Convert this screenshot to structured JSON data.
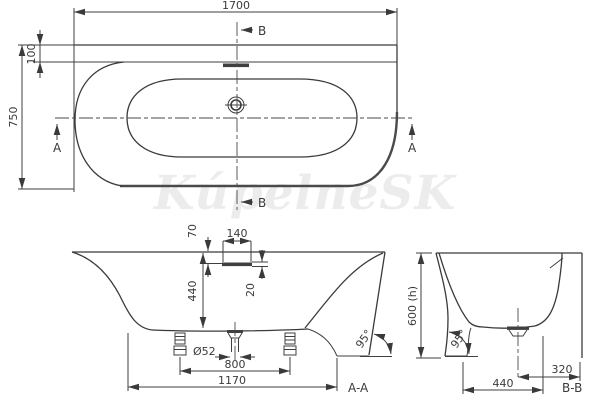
{
  "watermark": "KúpelneSK",
  "colors": {
    "line": "#3f3f3f",
    "thick_line": "#4a4a4a",
    "watermark": "#ececec",
    "background": "#ffffff"
  },
  "top_view": {
    "length": "1700",
    "width": "750",
    "rim_offset": "100",
    "section_a_marker": "A",
    "section_b_marker": "B"
  },
  "section_aa": {
    "label": "A-A",
    "overflow_width": "140",
    "overflow_depth": "70",
    "slot_height": "20",
    "inner_depth": "440",
    "drain_diameter": "Ø52",
    "feet_spacing": "800",
    "base_length": "1170",
    "wall_angle": "95°"
  },
  "section_bb": {
    "label": "B-B",
    "height": "600 (h)",
    "bottom_width": "440",
    "drain_offset": "320",
    "wall_angle": "95°"
  }
}
